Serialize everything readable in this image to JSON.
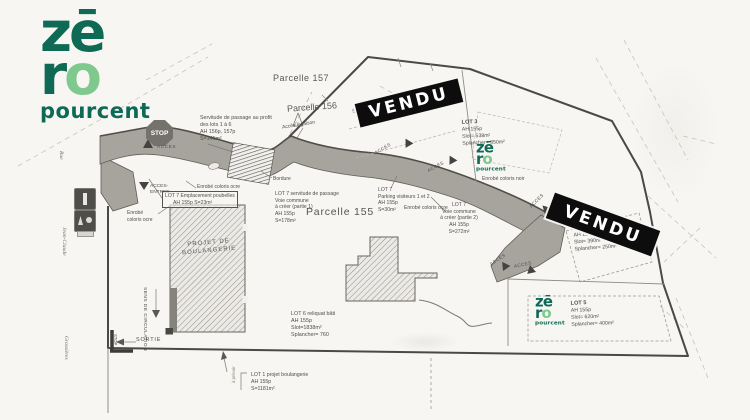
{
  "logo": {
    "top": "zē",
    "r": "r",
    "o": "o",
    "word": "pourcent"
  },
  "stamp": {
    "label": "VENDU"
  },
  "parcels": {
    "p157": "Parcelle 157",
    "p156": "Parcelle 156",
    "p155": "Parcelle 155"
  },
  "road": {
    "stop": "STOP",
    "acces": "ACCES",
    "entree1": "ACCES-",
    "entree2": "ENTREE",
    "sortie": "SORTIE",
    "sens": "SENS DE CIRCULATION",
    "stop_exit": "STOP",
    "bordure": "Bordure"
  },
  "streets": {
    "rue": "Rue",
    "jean_claude": "Jean-Claude",
    "grassieres": "Grassières"
  },
  "notes": {
    "servitude1": "Servitude de passage au profit",
    "servitude2": "des lots 1 à 6",
    "servitude3": "AH 156p, 157p",
    "servitude4": "S=141m²",
    "acces_livraison": "Accès livraison",
    "enrobe_ocre": "Enrobé coloris ocre",
    "enrobe1": "Enrobé",
    "enrobe2": "coloris ocre",
    "enrobe_noir": "Enrobé coloris noir",
    "poubelles1": "LOT 7 Emplacement poubelles",
    "poubelles2": "AH 155p S=23m²",
    "projet1": "PROJET DE",
    "projet2": "BOULANGERIE",
    "a_prevoir": "à prévoir"
  },
  "lots": {
    "lot1": {
      "l1": "LOT 1 projet boulangerie",
      "l2": "AH 155p",
      "l3": "S=1181m²"
    },
    "lot2": {
      "l1": "Slot= 305m²",
      "l2": "Splancher= 200m²"
    },
    "lot3": {
      "l1": "LOT 3",
      "l2": "AH 155p",
      "l3": "Slot= 538m²",
      "l4": "Splancher= 350m²"
    },
    "lot4": {
      "l1": "AH 155p",
      "l2": "Slot= 390m²",
      "l3": "Splancher= 250m²"
    },
    "lot5": {
      "l1": "LOT 5",
      "l2": "AH 155p",
      "l3": "Slot= 620m²",
      "l4": "Splancher= 400m²"
    },
    "lot6": {
      "l1": "LOT 6 reliquat bâti",
      "l2": "AH 155p",
      "l3": "Slot=1838m²",
      "l4": "Splancher= 760"
    },
    "lot7a": {
      "l1": "LOT 7 servitude de passage",
      "l2": "Voie commune",
      "l3": "à créer (partie 1)",
      "l4": "AH 155p",
      "l5": "S=178m²"
    },
    "lot7b": {
      "l1": "LOT 7",
      "l2": "Parking visiteurs 1 et 2",
      "l3": "AH 155p",
      "l4": "S=30m²"
    },
    "lot7c": {
      "l1": "LOT 7",
      "l2": "Voie commune",
      "l3": "à créer (partie 2)",
      "l4": "AH 155p",
      "l5": "S=272m²"
    }
  },
  "colors": {
    "brand_dark": "#0e6a55",
    "brand_light": "#7fc98f",
    "stamp_bg": "#0d0d0d",
    "stamp_text": "#ffffff"
  }
}
